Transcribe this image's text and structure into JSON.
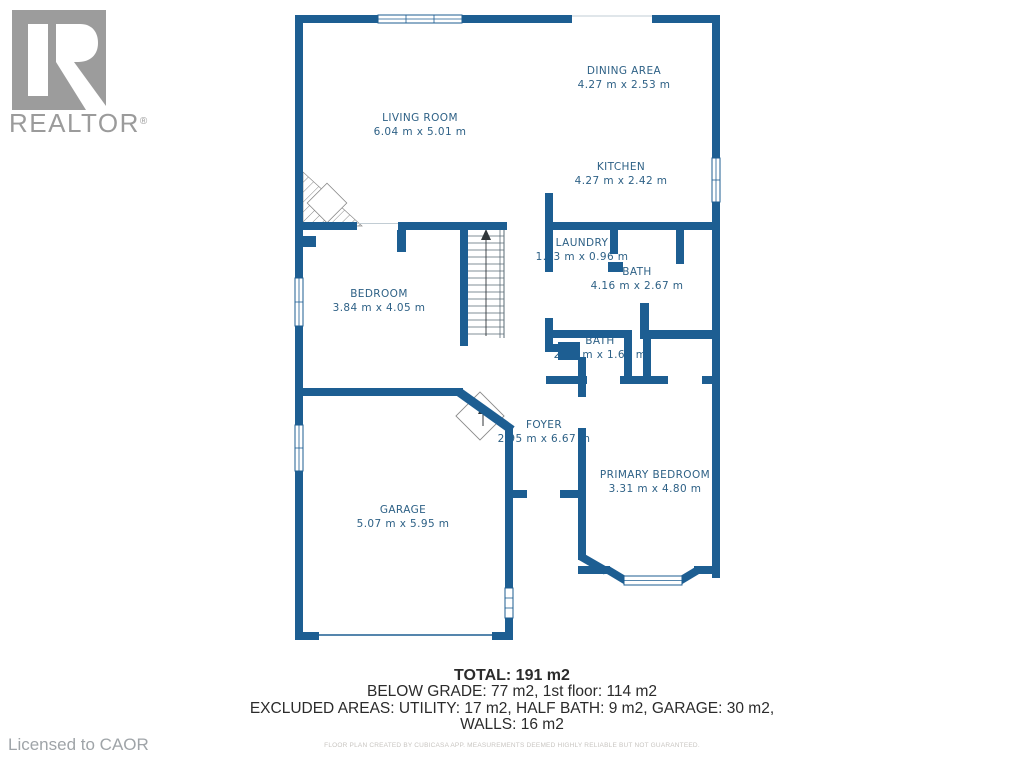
{
  "branding": {
    "logo_text": "REALTOR",
    "registered_mark": "®",
    "licensed_to": "Licensed to CAOR"
  },
  "floorplan": {
    "colors": {
      "wall": "#1d5e92",
      "label": "#2e6186"
    },
    "rooms": [
      {
        "name": "LIVING ROOM",
        "dims": "6.04 m x 5.01 m"
      },
      {
        "name": "DINING AREA",
        "dims": "4.27 m x 2.53 m"
      },
      {
        "name": "KITCHEN",
        "dims": "4.27 m x 2.42 m"
      },
      {
        "name": "LAUNDRY",
        "dims": "1.53 m x 0.96 m"
      },
      {
        "name": "BATH",
        "dims": "4.16 m x 2.67 m"
      },
      {
        "name": "BEDROOM",
        "dims": "3.84 m x 4.05 m"
      },
      {
        "name": "BATH",
        "dims": "2.05 m x 1.68 m"
      },
      {
        "name": "FOYER",
        "dims": "2.95 m x 6.67 m"
      },
      {
        "name": "PRIMARY BEDROOM",
        "dims": "3.31 m x 4.80 m"
      },
      {
        "name": "GARAGE",
        "dims": "5.07 m x 5.95 m"
      }
    ]
  },
  "summary": {
    "total": "TOTAL: 191 m2",
    "line1": "BELOW GRADE: 77 m2, 1st floor: 114 m2",
    "line2": "EXCLUDED AREAS: UTILITY: 17 m2, HALF BATH: 9 m2, GARAGE: 30 m2,",
    "line3": "WALLS: 16 m2",
    "disclaimer": "FLOOR PLAN CREATED BY CUBICASA APP. MEASUREMENTS DEEMED HIGHLY RELIABLE BUT NOT GUARANTEED."
  }
}
